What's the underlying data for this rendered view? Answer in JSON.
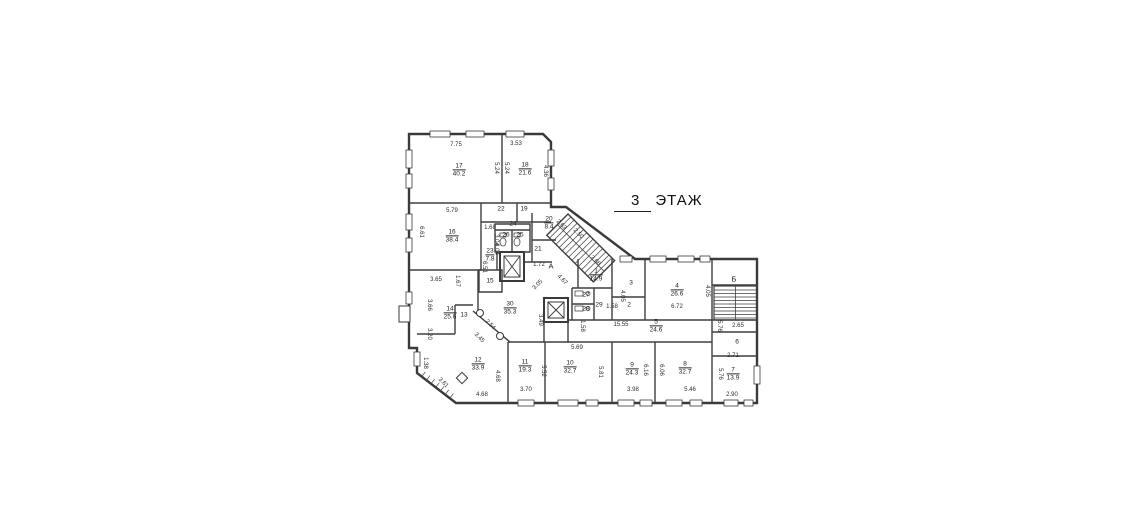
{
  "title": {
    "floor_number": "3",
    "floor_word": "ЭТАЖ"
  },
  "colors": {
    "wall_color": "#3a3a3a",
    "text_color": "#222222",
    "background": "#ffffff"
  },
  "plan": {
    "stair_labels": [
      {
        "text": "А",
        "x": 551,
        "y": 266
      },
      {
        "text": "Б",
        "x": 734,
        "y": 279
      }
    ],
    "rooms": [
      {
        "number": "17",
        "area": "40.2",
        "x": 459,
        "y": 170
      },
      {
        "number": "18",
        "area": "21.6",
        "x": 525,
        "y": 169
      },
      {
        "number": "16",
        "area": "38.4",
        "x": 452,
        "y": 236
      },
      {
        "number": "22",
        "x": 501,
        "y": 209
      },
      {
        "number": "19",
        "x": 524,
        "y": 209
      },
      {
        "number": "24",
        "x": 513,
        "y": 224
      },
      {
        "number": "26",
        "x": 506,
        "y": 235
      },
      {
        "number": "25",
        "x": 520,
        "y": 235
      },
      {
        "number": "20",
        "area": "8.4",
        "x": 549,
        "y": 223
      },
      {
        "number": "21",
        "x": 538,
        "y": 249
      },
      {
        "number": "23",
        "area": "7.8",
        "x": 490,
        "y": 255
      },
      {
        "number": "15",
        "x": 490,
        "y": 281
      },
      {
        "number": "14",
        "area": "25.6",
        "x": 450,
        "y": 313
      },
      {
        "number": "13",
        "x": 464,
        "y": 315
      },
      {
        "number": "30",
        "area": "35.3",
        "x": 510,
        "y": 308
      },
      {
        "number": "1",
        "area": "14.9",
        "x": 596,
        "y": 275
      },
      {
        "number": "3",
        "x": 631,
        "y": 283
      },
      {
        "number": "2",
        "x": 629,
        "y": 305
      },
      {
        "number": "4",
        "area": "26.6",
        "x": 677,
        "y": 290
      },
      {
        "number": "5",
        "area": "24.6",
        "x": 656,
        "y": 326
      },
      {
        "number": "27",
        "x": 586,
        "y": 295
      },
      {
        "number": "28",
        "x": 586,
        "y": 309
      },
      {
        "number": "29",
        "x": 599,
        "y": 305
      },
      {
        "number": "6",
        "x": 737,
        "y": 342
      },
      {
        "number": "7",
        "area": "13.9",
        "x": 733,
        "y": 374
      },
      {
        "number": "8",
        "area": "32.7",
        "x": 685,
        "y": 368
      },
      {
        "number": "9",
        "area": "24.3",
        "x": 632,
        "y": 369
      },
      {
        "number": "10",
        "area": "32.7",
        "x": 570,
        "y": 367
      },
      {
        "number": "11",
        "area": "19.3",
        "x": 525,
        "y": 366
      },
      {
        "number": "12",
        "area": "33.9",
        "x": 478,
        "y": 364
      }
    ],
    "dimensions": [
      {
        "text": "7.75",
        "x": 456,
        "y": 145,
        "rot": 0
      },
      {
        "text": "3.53",
        "x": 516,
        "y": 144,
        "rot": 0
      },
      {
        "text": "5.24",
        "x": 496,
        "y": 168,
        "rot": 90
      },
      {
        "text": "5.24",
        "x": 506,
        "y": 168,
        "rot": 90
      },
      {
        "text": "4.36",
        "x": 545,
        "y": 171,
        "rot": 90
      },
      {
        "text": "5.79",
        "x": 452,
        "y": 211,
        "rot": 0
      },
      {
        "text": "6.61",
        "x": 421,
        "y": 232,
        "rot": 90
      },
      {
        "text": "1.68",
        "x": 490,
        "y": 228,
        "rot": 0
      },
      {
        "text": "3.04",
        "x": 496,
        "y": 240,
        "rot": 90
      },
      {
        "text": "4.04",
        "x": 496,
        "y": 249,
        "rot": 90
      },
      {
        "text": "2.63",
        "x": 561,
        "y": 225,
        "rot": 45
      },
      {
        "text": "2.50",
        "x": 578,
        "y": 234,
        "rot": 45
      },
      {
        "text": "3.66",
        "x": 595,
        "y": 261,
        "rot": 45
      },
      {
        "text": "4.67",
        "x": 562,
        "y": 280,
        "rot": 45
      },
      {
        "text": "3.05",
        "x": 538,
        "y": 285,
        "rot": -45
      },
      {
        "text": "1.72",
        "x": 539,
        "y": 265,
        "rot": 0
      },
      {
        "text": "6.51",
        "x": 484,
        "y": 267,
        "rot": 90
      },
      {
        "text": "3.65",
        "x": 436,
        "y": 280,
        "rot": 0
      },
      {
        "text": "1.67",
        "x": 457,
        "y": 281,
        "rot": 90
      },
      {
        "text": "3.66",
        "x": 429,
        "y": 305,
        "rot": 90
      },
      {
        "text": "3.20",
        "x": 429,
        "y": 334,
        "rot": 90
      },
      {
        "text": "1.38",
        "x": 425,
        "y": 363,
        "rot": 90
      },
      {
        "text": "3.61",
        "x": 443,
        "y": 383,
        "rot": 45
      },
      {
        "text": "2.54",
        "x": 490,
        "y": 325,
        "rot": 45
      },
      {
        "text": "3.45",
        "x": 479,
        "y": 338,
        "rot": 45
      },
      {
        "text": "3.49",
        "x": 540,
        "y": 320,
        "rot": 90
      },
      {
        "text": "4.68",
        "x": 497,
        "y": 376,
        "rot": 90
      },
      {
        "text": "4.68",
        "x": 482,
        "y": 395,
        "rot": 0
      },
      {
        "text": "3.70",
        "x": 526,
        "y": 390,
        "rot": 0
      },
      {
        "text": "5.52",
        "x": 543,
        "y": 371,
        "rot": 90
      },
      {
        "text": "5.69",
        "x": 577,
        "y": 348,
        "rot": 0
      },
      {
        "text": "5.81",
        "x": 600,
        "y": 372,
        "rot": 90
      },
      {
        "text": "3.98",
        "x": 633,
        "y": 390,
        "rot": 0
      },
      {
        "text": "6.16",
        "x": 645,
        "y": 370,
        "rot": 90
      },
      {
        "text": "6.06",
        "x": 661,
        "y": 370,
        "rot": 90
      },
      {
        "text": "5.46",
        "x": 690,
        "y": 390,
        "rot": 0
      },
      {
        "text": "5.76",
        "x": 720,
        "y": 374,
        "rot": 90
      },
      {
        "text": "2.90",
        "x": 732,
        "y": 395,
        "rot": 0
      },
      {
        "text": "2.71",
        "x": 733,
        "y": 356,
        "rot": 0
      },
      {
        "text": "2.65",
        "x": 738,
        "y": 326,
        "rot": 0
      },
      {
        "text": "5.76",
        "x": 719,
        "y": 326,
        "rot": 90
      },
      {
        "text": "4.05",
        "x": 622,
        "y": 296,
        "rot": 90
      },
      {
        "text": "4.05",
        "x": 707,
        "y": 291,
        "rot": 90
      },
      {
        "text": "6.72",
        "x": 677,
        "y": 307,
        "rot": 0
      },
      {
        "text": "1.58",
        "x": 612,
        "y": 307,
        "rot": 0
      },
      {
        "text": "1.58",
        "x": 582,
        "y": 326,
        "rot": 90
      },
      {
        "text": "15.55",
        "x": 621,
        "y": 325,
        "rot": 0
      }
    ]
  }
}
